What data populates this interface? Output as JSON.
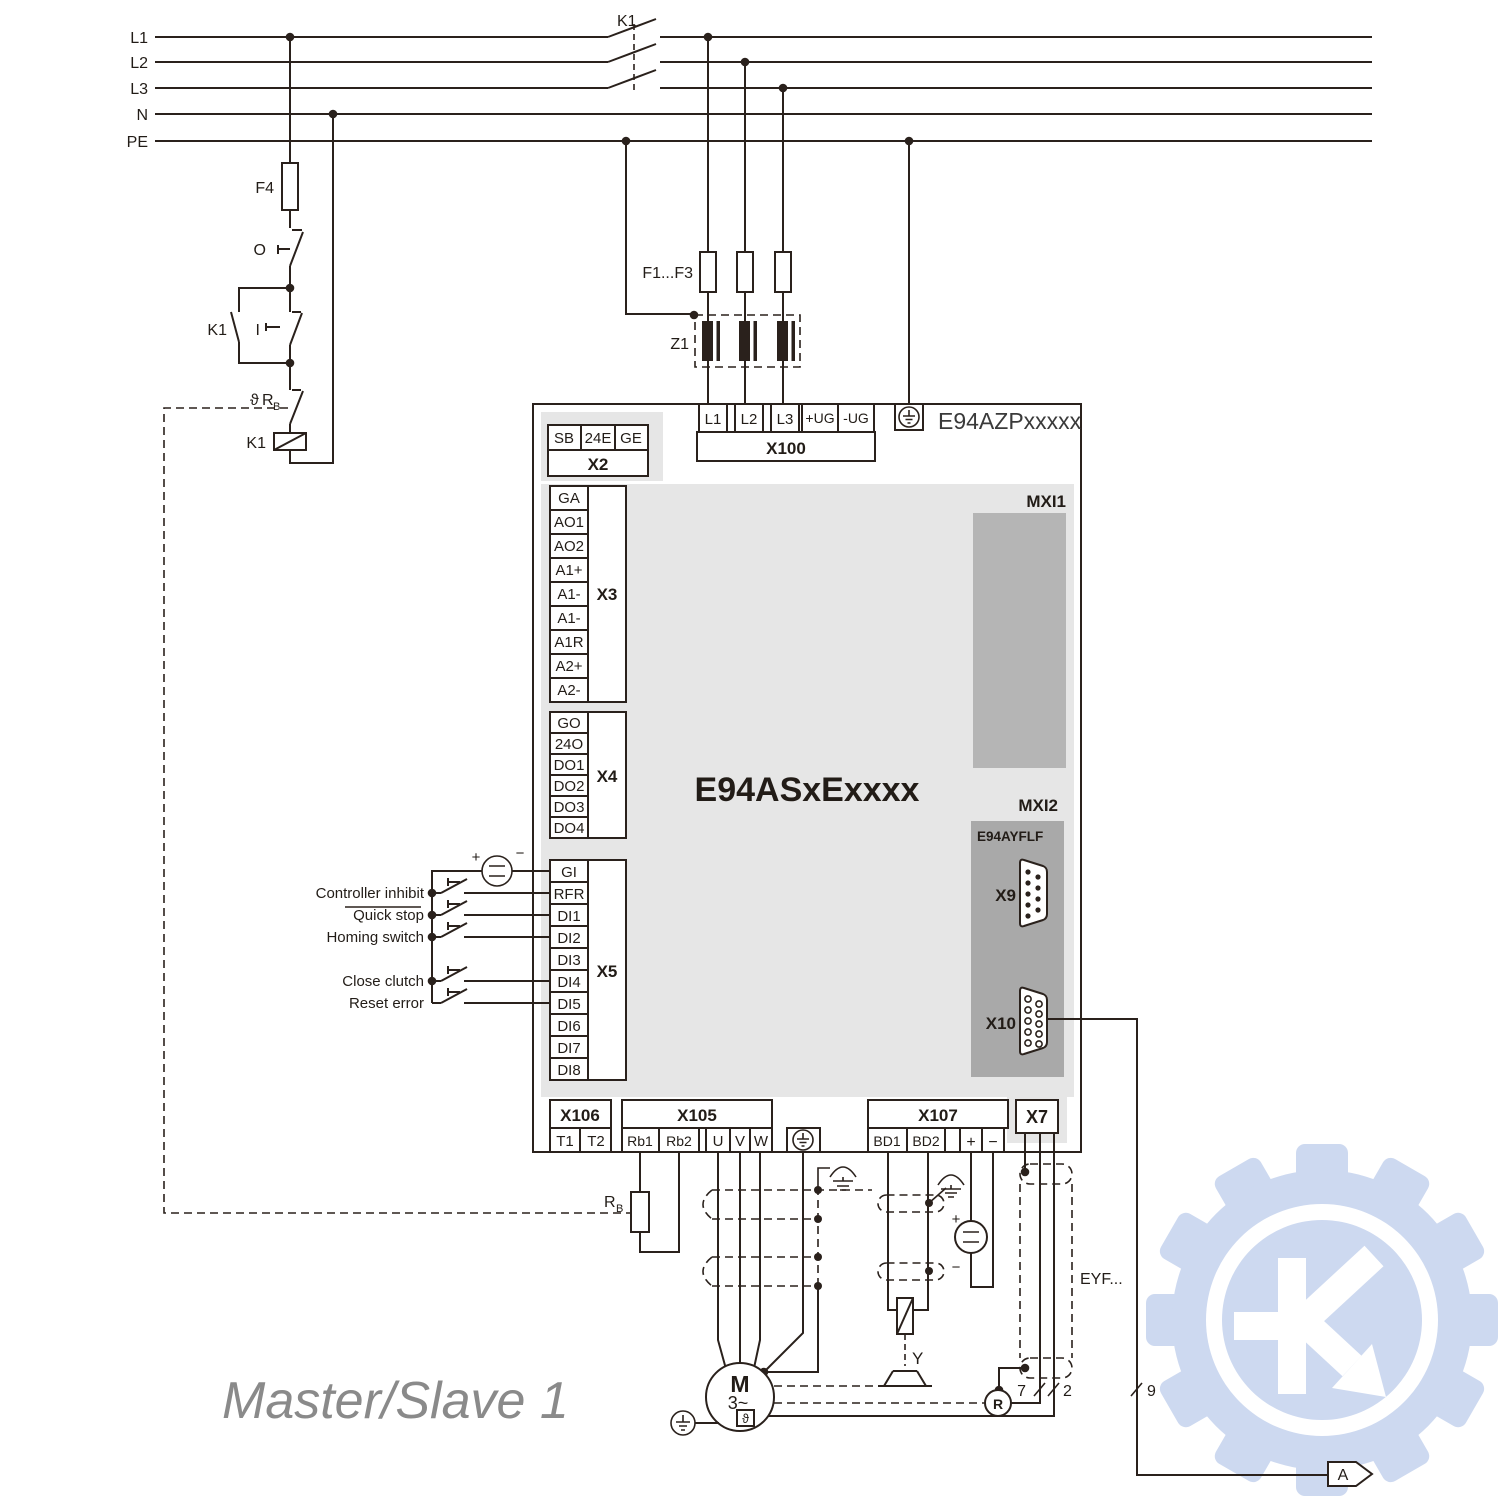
{
  "title": "Master/Slave 1",
  "power_rails": {
    "labels": [
      "L1",
      "L2",
      "L3",
      "N",
      "PE"
    ]
  },
  "supply_circuit": {
    "contactor": "K1",
    "fuse": "F4",
    "stop_button": "O",
    "start_button": "I",
    "aux_contact": "K1",
    "thermal_contact": {
      "theta": "ϑ",
      "main": "R",
      "sub": "B"
    },
    "coil": "K1",
    "line_fuses": "F1...F3",
    "filter": "Z1"
  },
  "drive": {
    "power_board": "E94AZPxxxxx",
    "device": "E94ASxExxxx",
    "mxi1": "MXI1",
    "mxi2": "MXI2",
    "module": {
      "name": "E94AYFLF",
      "x9": "X9",
      "x10": "X10"
    },
    "x2": {
      "name": "X2",
      "pins": [
        "SB",
        "24E",
        "GE"
      ]
    },
    "x100": {
      "name": "X100",
      "pins": [
        "L1",
        "L2",
        "L3",
        "+UG",
        "-UG"
      ]
    },
    "x3": {
      "name": "X3",
      "pins": [
        "GA",
        "AO1",
        "AO2",
        "A1+",
        "A1-",
        "A1-",
        "A1R",
        "A2+",
        "A2-"
      ]
    },
    "x4": {
      "name": "X4",
      "pins": [
        "GO",
        "24O",
        "DO1",
        "DO2",
        "DO3",
        "DO4"
      ]
    },
    "x5": {
      "name": "X5",
      "pins": [
        "GI",
        "RFR",
        "DI1",
        "DI2",
        "DI3",
        "DI4",
        "DI5",
        "DI6",
        "DI7",
        "DI8"
      ]
    },
    "x106": {
      "name": "X106",
      "pins": [
        "T1",
        "T2"
      ]
    },
    "x105": {
      "name": "X105",
      "pins": [
        "Rb1",
        "Rb2",
        "U",
        "V",
        "W"
      ]
    },
    "x107": {
      "name": "X107",
      "pins": [
        "BD1",
        "BD2",
        "+",
        "−"
      ]
    },
    "x7": {
      "name": "X7"
    }
  },
  "digital_inputs": {
    "supply_plus": "+",
    "supply_minus": "−",
    "labels": [
      "Controller inhibit",
      "Quick stop",
      "Homing switch",
      "Close clutch",
      "Reset error"
    ]
  },
  "motor_section": {
    "brake_resistor": {
      "main": "R",
      "sub": "B"
    },
    "motor": "M",
    "phases": "3~",
    "temp_sensor": "ϑ",
    "brake": "Y",
    "resolver": "R",
    "feedback_cable": "EYF...",
    "brake_supply_plus": "+",
    "brake_supply_minus": "−",
    "wire_counts": {
      "resolver": "7",
      "thermal": "2",
      "encoder": "9"
    },
    "connector_ref": "A"
  }
}
